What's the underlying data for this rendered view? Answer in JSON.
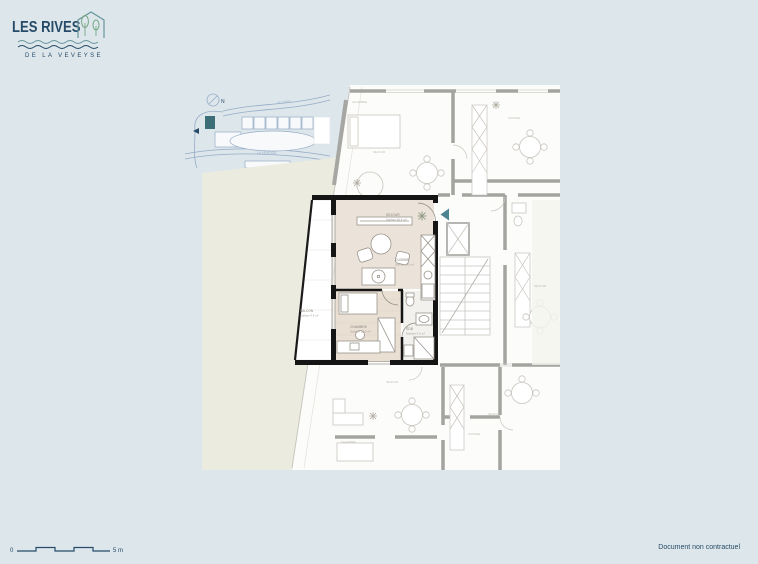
{
  "page": {
    "background": "#dde7eb"
  },
  "logo": {
    "title": "LES RIVES",
    "subtitle": "DE LA VEVEYSE",
    "navy": "#264a67",
    "teal": "#67969c",
    "green": "#76a683"
  },
  "site_map": {
    "north_label": "N",
    "road_label": "LE LUSSY",
    "river_label": "LA VEVEYSE",
    "line_color": "#96abc6",
    "highlight_building_color": "#3c6e77"
  },
  "floor_plan": {
    "highlight_wall_color": "#151515",
    "neighbor_wall_color": "#a3a3a0",
    "entrance_arrow_color": "#4c8492",
    "rooms": [
      {
        "name": "SEJOUR",
        "surface": "Surface 26.4 m²"
      },
      {
        "name": "CUISINE",
        "surface": "Surface 6.1 m²"
      },
      {
        "name": "CHAMBRE",
        "surface": "Surface 13.0 m²"
      },
      {
        "name": "SDB",
        "surface": "Surface 4.2 m²"
      },
      {
        "name": "BALCON",
        "surface": "Surface 4.6 m²"
      }
    ],
    "neighbor_labels": [
      {
        "name": "CHAMBRE"
      },
      {
        "name": "SEJOUR"
      },
      {
        "name": "CUISINE"
      },
      {
        "name": "SEJOUR"
      },
      {
        "name": "SEJOUR"
      },
      {
        "name": "CHAMBRE"
      },
      {
        "name": "SEJOUR"
      },
      {
        "name": "CUISINE"
      }
    ]
  },
  "scale_bar": {
    "start_label": "0",
    "end_label": "5 m"
  },
  "footer": {
    "note": "Document non contractuel"
  }
}
